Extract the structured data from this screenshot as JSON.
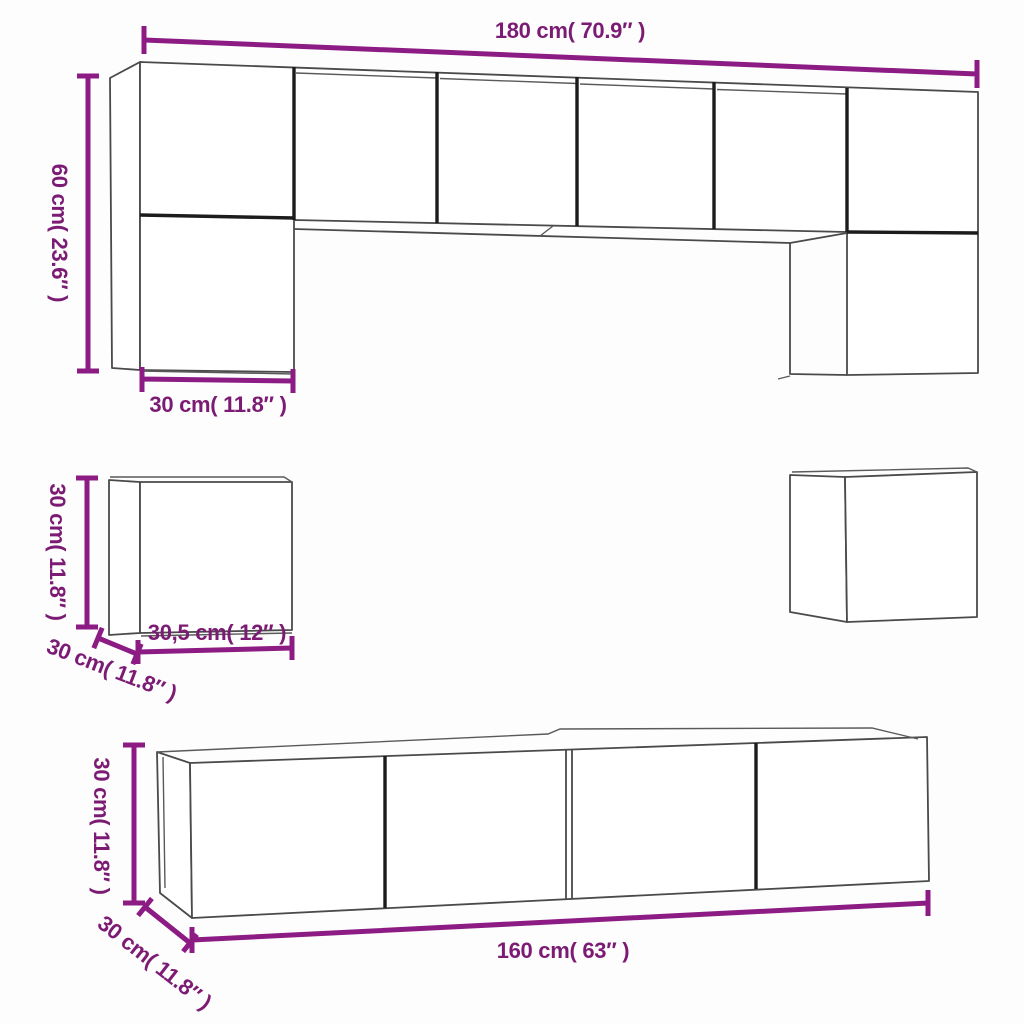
{
  "diagram": {
    "kind": "furniture-dimension-line-drawing",
    "subject": "TV wall cabinet set (8 pieces)",
    "colors": {
      "dimension_line": "#8c1c84",
      "dimension_text": "#7c1b74",
      "cabinet_edge": "#4a4a4a",
      "cabinet_edge_bold": "#1c1c1c",
      "background": "#fdfdfd"
    },
    "top_unit": {
      "width_label": "180 cm( 70.9″ )",
      "height_label": "60 cm( 23.6″ )",
      "depth_label": "30 cm( 11.8″ )"
    },
    "wall_cube": {
      "height_label": "30 cm( 11.8″ )",
      "width_label": "30,5 cm( 12″ )",
      "depth_label": "30 cm( 11.8″ )"
    },
    "tv_bench": {
      "height_label": "30 cm( 11.8″ )",
      "depth_label": "30 cm( 11.8″ )",
      "width_label": "160 cm( 63″ )"
    }
  }
}
